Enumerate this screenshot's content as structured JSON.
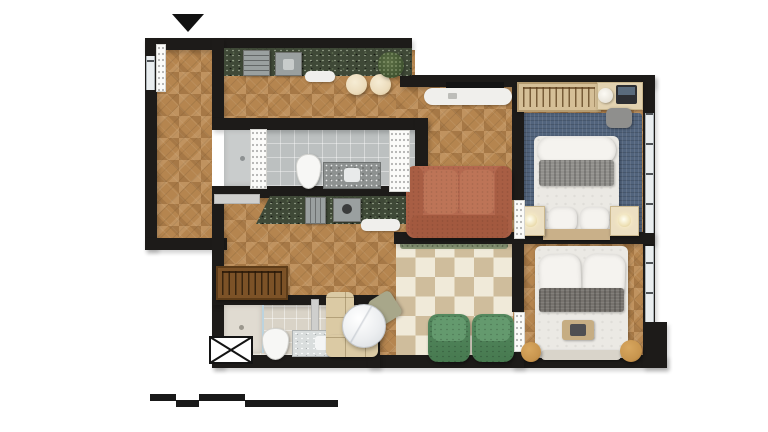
{
  "document": {
    "type": "rendered apartment floor plan, top-down 3D view",
    "background": "white",
    "entrance_marker": "black triangle arrow pointing down at the entry door (top left)",
    "scale_bar": {
      "position": "bottom left",
      "style": "stepped alternating black bars",
      "segments": 4
    }
  },
  "colors": {
    "wall": "#1d1b19",
    "wood": "#b5854f",
    "checker_beige": "#cfbd9c",
    "checker_cream": "#f0ead9",
    "counter_granite": "#3f4937",
    "vanity_granite": "#8d9190",
    "tile_gray": "#bcc0c0",
    "bath2_floor": "#d9d3c7",
    "rug_blue": "#52647d",
    "sofa_terracotta": "#b4694f",
    "armchair_green": "#55895f",
    "armchair_green_dark": "#477a50",
    "banquette_beige": "#dbcaa4",
    "chair_sage": "#a8a78a",
    "table_marble": "#eceef0",
    "closet_brown": "#7c5227",
    "wardrobe_tan": "#d5bf97",
    "desk_cream": "#e2d2b0",
    "nightstand_cream": "#ecdfc2",
    "pouf_tan": "#c7944d",
    "planter_green": "#8e9b7a",
    "blanket_gray_bed1": "#908f8b",
    "blanket_gray_bed2": "#76726d",
    "duvet_white": "#ebe9e4",
    "pillow_white": "#f5f3ef",
    "window_glass": "#e9edef",
    "door_white": "#fbfbf9",
    "door_gray": "#cfcfcd",
    "stool_cream": "#ecdcbc",
    "bed_headboard_tan": "#c9b089",
    "bench_light": "#d9d4ca",
    "tray_tan": "#c6ad83",
    "tv_black": "#141414",
    "shelf_white": "#f0efec",
    "appliance_gray": "#9aa0a0"
  },
  "rooms": [
    {
      "id": "entry-hall",
      "floor": "herringbone wood",
      "features": [
        "entry door with open leaf",
        "small window on left wall"
      ]
    },
    {
      "id": "kitchen-galley",
      "floor": "herringbone wood",
      "features": [
        "upper dark-granite counter with stove and sink",
        "lower dark-granite counter with oven and cooktop",
        "two cream stools",
        "potted plant",
        "white shelves"
      ]
    },
    {
      "id": "bathroom-1",
      "floor": "gray tile",
      "features": [
        "walk-in shower",
        "toilet",
        "granite vanity with sink",
        "two white door panels"
      ]
    },
    {
      "id": "hallway",
      "floor": "herringbone wood",
      "features": [
        "coat closet with hangers",
        "gray sliding door"
      ]
    },
    {
      "id": "bathroom-2",
      "floor": "beige tile",
      "features": [
        "shower",
        "toilet",
        "marble vanity with sink",
        "service shaft marked with X"
      ]
    },
    {
      "id": "dining-nook",
      "floor": "herringbone wood",
      "features": [
        "L-shaped beige banquette",
        "round marble table",
        "sage side chair"
      ]
    },
    {
      "id": "dining-area",
      "floor": "beige and cream checkerboard",
      "features": [
        "planter strip along wall",
        "two green armchairs"
      ]
    },
    {
      "id": "living-room",
      "floor": "herringbone wood",
      "features": [
        "terracotta two-seat sofa",
        "wall-mounted TV",
        "white media console"
      ]
    },
    {
      "id": "bedroom-1",
      "floor": "wood with blue rug",
      "features": [
        "double bed with gray throw",
        "two cream nightstands with lamps",
        "tan headboard",
        "open wardrobe with hangers",
        "desk with laptop and chair"
      ]
    },
    {
      "id": "bedroom-2",
      "floor": "herringbone wood",
      "features": [
        "double bed with dark throw and breakfast tray",
        "foot-of-bed bench",
        "two tan poufs",
        "window"
      ]
    }
  ]
}
